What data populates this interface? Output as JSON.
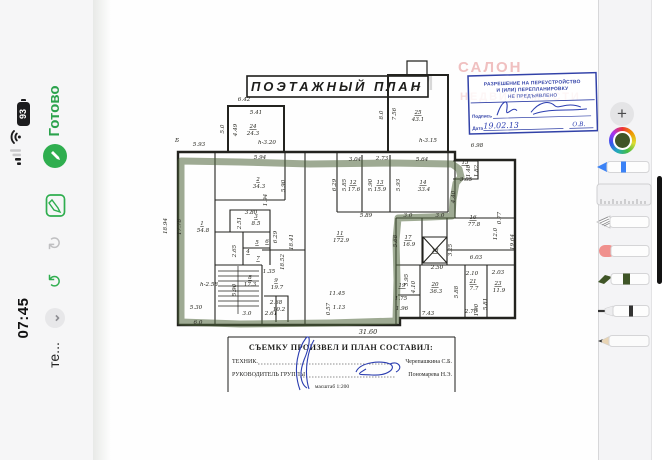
{
  "status_bar": {
    "time": "07:45",
    "app_label": "те...",
    "battery_percent": "93",
    "icons": [
      "cellular-signal",
      "wifi",
      "battery"
    ]
  },
  "nav": {
    "done_label": "Готово",
    "icons": [
      "pencil-circle",
      "markup",
      "redo",
      "undo",
      "chevron-down"
    ]
  },
  "document": {
    "title": "ПОЭТАЖНЫЙ ПЛАН",
    "watermarks": [
      "САЛОН",
      "РИМ",
      "НЕДВИЖИМОСТИ"
    ],
    "stamp": {
      "line1": "РАЗРЕШЕНИЕ НА ПЕРЕУСТРОЙСТВО",
      "line2": "И (ИЛИ) ПЕРЕПЛАНИРОВКУ",
      "line3": "НЕ ПРЕДЪЯВЛЕНО",
      "field_signature": "Подпись",
      "field_date": "Дата",
      "date_value": "19.02.13",
      "initials": "О.В."
    },
    "title_block": {
      "heading": "СЪЕМКУ ПРОИЗВЕЛ И ПЛАН СОСТАВИЛ:",
      "row1_label": "ТЕХНИК.",
      "row1_name": "Черепашкина С.Б.",
      "row2_label": "РУКОВОДИТЕЛЬ ГРУППЫ",
      "row2_name": "Пономарева Н.Э.",
      "scale": "масштаб 1:200"
    },
    "plan": {
      "highlight_color": "rgba(79,101,58,0.55)",
      "labels": [
        {
          "t": "6.42",
          "x": 244,
          "y": 101
        },
        {
          "t": "5.41",
          "x": 256,
          "y": 114
        },
        {
          "t": "5.0",
          "x": 224,
          "y": 129,
          "r": -90
        },
        {
          "t": "4.49",
          "x": 237,
          "y": 130,
          "r": -90
        },
        {
          "t": "24",
          "x": 253,
          "y": 128,
          "u": 1
        },
        {
          "t": "24.3",
          "x": 253,
          "y": 135
        },
        {
          "t": "h-3.20",
          "x": 267,
          "y": 144
        },
        {
          "t": "Б",
          "x": 177,
          "y": 142
        },
        {
          "t": "5.93",
          "x": 199,
          "y": 146
        },
        {
          "t": "5.7",
          "x": 416,
          "y": 90
        },
        {
          "t": "8.0",
          "x": 383,
          "y": 115,
          "r": -90
        },
        {
          "t": "7.56",
          "x": 396,
          "y": 114,
          "r": -90
        },
        {
          "t": "25",
          "x": 418,
          "y": 114,
          "u": 1
        },
        {
          "t": "43.1",
          "x": 418,
          "y": 121
        },
        {
          "t": "h-3.15",
          "x": 428,
          "y": 142
        },
        {
          "t": "6.98",
          "x": 477,
          "y": 147
        },
        {
          "t": "18.94",
          "x": 167,
          "y": 226,
          "r": -90
        },
        {
          "t": "17.78",
          "x": 181,
          "y": 227,
          "r": -90
        },
        {
          "t": "1",
          "x": 202,
          "y": 225,
          "u": 1
        },
        {
          "t": "54.8",
          "x": 203,
          "y": 232
        },
        {
          "t": "h-2.58",
          "x": 209,
          "y": 286
        },
        {
          "t": "5.30",
          "x": 196,
          "y": 309
        },
        {
          "t": "6.0",
          "x": 198,
          "y": 324
        },
        {
          "t": "5.94",
          "x": 260,
          "y": 159
        },
        {
          "t": "2",
          "x": 258,
          "y": 181,
          "u": 1
        },
        {
          "t": "34.3",
          "x": 259,
          "y": 188
        },
        {
          "t": "5.90",
          "x": 285,
          "y": 186,
          "r": -90
        },
        {
          "t": "1.94",
          "x": 267,
          "y": 200,
          "r": -90
        },
        {
          "t": "3.80",
          "x": 251,
          "y": 214
        },
        {
          "t": "2.51",
          "x": 241,
          "y": 223,
          "r": -90
        },
        {
          "t": "3",
          "x": 256,
          "y": 218,
          "u": 1
        },
        {
          "t": "8.5",
          "x": 256,
          "y": 225
        },
        {
          "t": "2.65",
          "x": 236,
          "y": 251,
          "r": -90
        },
        {
          "t": "4",
          "x": 248,
          "y": 253,
          "u": 1
        },
        {
          "t": "5",
          "x": 257,
          "y": 244,
          "u": 1
        },
        {
          "t": "6",
          "x": 267,
          "y": 243,
          "u": 1
        },
        {
          "t": "7",
          "x": 258,
          "y": 260,
          "u": 1
        },
        {
          "t": "6.29",
          "x": 277,
          "y": 237,
          "r": -90
        },
        {
          "t": "8",
          "x": 250,
          "y": 279,
          "u": 1
        },
        {
          "t": "17.3",
          "x": 250,
          "y": 286
        },
        {
          "t": "5.90",
          "x": 236,
          "y": 290,
          "r": -90
        },
        {
          "t": "1.35",
          "x": 269,
          "y": 273
        },
        {
          "t": "9",
          "x": 276,
          "y": 282,
          "u": 1
        },
        {
          "t": "19.7",
          "x": 277,
          "y": 289
        },
        {
          "t": "18.52",
          "x": 284,
          "y": 262,
          "r": -90
        },
        {
          "t": "18.41",
          "x": 293,
          "y": 242,
          "r": -90
        },
        {
          "t": "2.68",
          "x": 276,
          "y": 304
        },
        {
          "t": "10.2",
          "x": 279,
          "y": 311
        },
        {
          "t": "2.61",
          "x": 271,
          "y": 315
        },
        {
          "t": "3.0",
          "x": 247,
          "y": 315
        },
        {
          "t": "11",
          "x": 340,
          "y": 235,
          "u": 1
        },
        {
          "t": "172.9",
          "x": 341,
          "y": 242
        },
        {
          "t": "11.45",
          "x": 337,
          "y": 295
        },
        {
          "t": "0.57",
          "x": 330,
          "y": 309,
          "r": -90
        },
        {
          "t": "1.13",
          "x": 339,
          "y": 309
        },
        {
          "t": "3.04",
          "x": 355,
          "y": 161
        },
        {
          "t": "2.73",
          "x": 382,
          "y": 160
        },
        {
          "t": "5.64",
          "x": 422,
          "y": 161
        },
        {
          "t": "6.29",
          "x": 336,
          "y": 185,
          "r": -90
        },
        {
          "t": "5.85",
          "x": 346,
          "y": 185,
          "r": -90
        },
        {
          "t": "12",
          "x": 353,
          "y": 184,
          "u": 1
        },
        {
          "t": "17.6",
          "x": 354,
          "y": 191
        },
        {
          "t": "5.90",
          "x": 372,
          "y": 185,
          "r": -90
        },
        {
          "t": "13",
          "x": 380,
          "y": 184,
          "u": 1
        },
        {
          "t": "15.9",
          "x": 380,
          "y": 191
        },
        {
          "t": "5.93",
          "x": 400,
          "y": 185,
          "r": -90
        },
        {
          "t": "14",
          "x": 423,
          "y": 184,
          "u": 1
        },
        {
          "t": "33.4",
          "x": 424,
          "y": 191
        },
        {
          "t": "5.89",
          "x": 366,
          "y": 217
        },
        {
          "t": "3.0",
          "x": 408,
          "y": 217
        },
        {
          "t": "3.0",
          "x": 440,
          "y": 217
        },
        {
          "t": "4.40",
          "x": 455,
          "y": 197,
          "r": -90
        },
        {
          "t": "15",
          "x": 465,
          "y": 164,
          "u": 1
        },
        {
          "t": "1.48",
          "x": 470,
          "y": 171,
          "r": -90
        },
        {
          "t": "1.82",
          "x": 478,
          "y": 171,
          "r": -90
        },
        {
          "t": "3.05",
          "x": 466,
          "y": 181
        },
        {
          "t": "16",
          "x": 473,
          "y": 219,
          "u": 1
        },
        {
          "t": "77.8",
          "x": 474,
          "y": 226
        },
        {
          "t": "12.0",
          "x": 497,
          "y": 234,
          "r": -90
        },
        {
          "t": "0.77",
          "x": 501,
          "y": 218,
          "r": -90
        },
        {
          "t": "19.64",
          "x": 514,
          "y": 242,
          "r": -90
        },
        {
          "t": "6.03",
          "x": 476,
          "y": 259
        },
        {
          "t": "17",
          "x": 408,
          "y": 239,
          "u": 1
        },
        {
          "t": "16.9",
          "x": 409,
          "y": 246
        },
        {
          "t": "5.68",
          "x": 397,
          "y": 241,
          "r": -90
        },
        {
          "t": "18",
          "x": 435,
          "y": 252,
          "u": 1
        },
        {
          "t": "3.25",
          "x": 452,
          "y": 250,
          "r": -90
        },
        {
          "t": "2.50",
          "x": 437,
          "y": 269
        },
        {
          "t": "3.95",
          "x": 408,
          "y": 280,
          "r": -90
        },
        {
          "t": "4.10",
          "x": 415,
          "y": 287,
          "r": -90
        },
        {
          "t": "19",
          "x": 402,
          "y": 287,
          "u": 1
        },
        {
          "t": "1.75",
          "x": 401,
          "y": 300
        },
        {
          "t": "1.96",
          "x": 402,
          "y": 310
        },
        {
          "t": "20",
          "x": 435,
          "y": 286,
          "u": 1
        },
        {
          "t": "36.3",
          "x": 436,
          "y": 293
        },
        {
          "t": "5.88",
          "x": 458,
          "y": 292,
          "r": -90
        },
        {
          "t": "7.43",
          "x": 428,
          "y": 315
        },
        {
          "t": "2.10",
          "x": 472,
          "y": 275
        },
        {
          "t": "21",
          "x": 473,
          "y": 283,
          "u": 1
        },
        {
          "t": "7.7",
          "x": 474,
          "y": 290
        },
        {
          "t": "1.90",
          "x": 478,
          "y": 310,
          "r": -90
        },
        {
          "t": "2.70",
          "x": 471,
          "y": 313
        },
        {
          "t": "2.03",
          "x": 498,
          "y": 274
        },
        {
          "t": "23",
          "x": 498,
          "y": 285,
          "u": 1
        },
        {
          "t": "11.9",
          "x": 499,
          "y": 292
        },
        {
          "t": "5.81",
          "x": 487,
          "y": 304,
          "r": -90
        },
        {
          "t": "31.60",
          "x": 368,
          "y": 334,
          "s": 6.5
        }
      ]
    }
  },
  "toolbar": {
    "plus_label": "+",
    "selected_color": "#3f5527",
    "tools": [
      "pen",
      "ruler",
      "lasso-pencil",
      "eraser",
      "highlighter",
      "fine-liner",
      "pencil"
    ]
  }
}
